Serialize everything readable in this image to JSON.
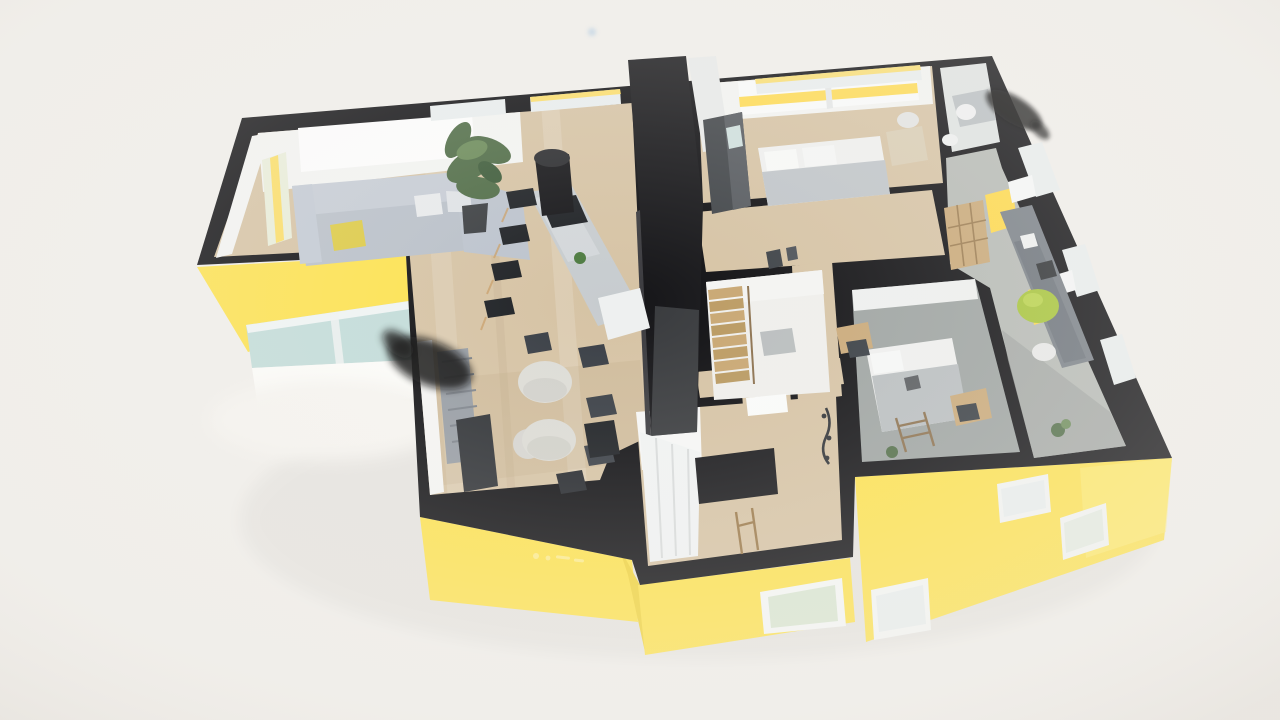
{
  "scene": {
    "type": "3d-floorplan-render",
    "description": "Isometric 3D cutaway floor plan render of an apartment with bright yellow exterior facades, black wall tops, wood and gray floors, furnished rooms"
  },
  "palette": {
    "background": "#f1efeb",
    "wall_top_black": "#0e0e11",
    "facade_yellow": "#fde24f",
    "facade_yellow_light": "#ffec7a",
    "facade_yellow_dark": "#f0d33e",
    "glass_teal": "#c2dcd9",
    "glass_pale": "#e9eeee",
    "glass_green": "#d9e6d2",
    "accent_yellow": "#ffd94a",
    "floor_wood": "#d6c3a4",
    "floor_wood_light": "#e2d3b8",
    "floor_gray": "#b6bab5",
    "carpet_gray": "#9da3a1",
    "floor_white": "#efefec",
    "interior_white": "#f3f4f2",
    "column_dark": "#141417",
    "island_gray": "#c7cccf",
    "sofa_gray": "#b9c0c9",
    "sofa_gray_light": "#c6ccd5",
    "pillow_yellow": "#ddca45",
    "plant_green": "#4e6b45",
    "beanbag_green": "#a6c438",
    "furniture_dark": "#1d2024",
    "desk_gray": "#787f86",
    "wood_furniture": "#c9a877",
    "bed_white": "#eff0ef",
    "blanket_gray": "#c0c5c9"
  },
  "rooms": [
    {
      "name": "open-living-kitchen-dining",
      "floor": "wood"
    },
    {
      "name": "master-bedroom",
      "floor": "wood"
    },
    {
      "name": "bathroom",
      "floor": "gray"
    },
    {
      "name": "kids-room-office",
      "floor": "gray"
    },
    {
      "name": "stair-room",
      "floor": "white"
    },
    {
      "name": "bedroom",
      "floor": "gray-carpet"
    },
    {
      "name": "entry-hall",
      "floor": "wood"
    },
    {
      "name": "hallway",
      "floor": "wood"
    }
  ],
  "furniture": [
    "corner-sofa",
    "potted-plant",
    "kitchen-island",
    "range-hood",
    "bar-stools",
    "dining-tables",
    "dining-chairs",
    "radiator",
    "tv-bench",
    "pouf",
    "double-bed",
    "wardrobe",
    "desk",
    "office-chair",
    "bean-bag",
    "wall-shelf",
    "single-bed",
    "bunk-ladder",
    "stairs",
    "coat-rack",
    "entry-wardrobe"
  ]
}
